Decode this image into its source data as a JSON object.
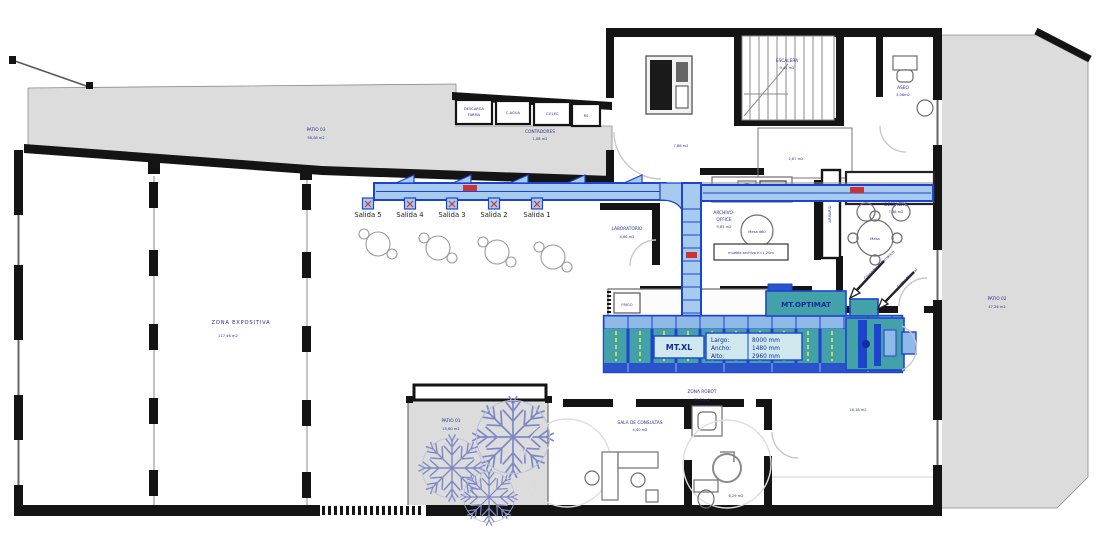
{
  "colors": {
    "patio_fill": "#dcdcdc",
    "wall": "#141414",
    "label_navy": "#2b2f94",
    "machine_blue": "#1d43cf",
    "machine_fill": "#a7cbee",
    "machine_teal": "#43a1a9",
    "accent_red": "#cc3333",
    "dash_yellow": "#e6f23a"
  },
  "exits": [
    "Salida 5",
    "Salida 4",
    "Salida 3",
    "Salida 2",
    "Salida 1"
  ],
  "machines": {
    "optimat_label": "MT.OPTIMAT",
    "xl_label": "MT.XL",
    "dims": [
      {
        "k": "Largo:",
        "v": "8000 mm"
      },
      {
        "k": "Ancho:",
        "v": "1480 mm"
      },
      {
        "k": "Alto:",
        "v": "2960 mm"
      }
    ],
    "arrow_auto": "Cargador Automático",
    "arrow_manual": "Carga Manual"
  },
  "rooms": {
    "patio03": {
      "name": "PATIO 03",
      "area": "98,08 m2"
    },
    "patio02": {
      "name": "PATIO 02",
      "area": "47,26 m2"
    },
    "patio01": {
      "name": "PATIO 01",
      "area": "15,60 m2"
    },
    "zona_expositiva": {
      "name": "ZONA EXPOSITIVA",
      "area": "117,46 m2"
    },
    "zona_robot": {
      "name": "ZONA ROBOT",
      "area": "35,81m2"
    },
    "sala_consultas": {
      "name": "SALA DE CONSULTAS",
      "area": "4,40 m2"
    },
    "laboratorio": {
      "name": "LABORATORIO",
      "area": "4,86 m2"
    },
    "archivo": {
      "line1": "ARCHIVO-",
      "line2": "OFFICE",
      "area": "9,85 m2"
    },
    "despacho": {
      "name": "DESPACHO",
      "area": "7,38 m2"
    },
    "escalera": {
      "name": "ESCALERA",
      "area": "9,41 m2"
    },
    "aseo": {
      "name": "ASEO",
      "area": "3,08m2"
    },
    "contadores": {
      "name": "CONTADORES",
      "area": "1,08 m2"
    },
    "descarga": {
      "line1": "DESCARGA",
      "line2": "FARMA"
    },
    "c_agua": "C.AGUA",
    "c_elec": "C.ELEC",
    "rs": "RS",
    "armario": "ARMARIO"
  },
  "annotations": {
    "mueble": "mueble archivo h=1,20m",
    "mesa_d80": "Mesa d80",
    "mesa": "Mesa",
    "frigo": "FRIGO",
    "area_788": "7,88 m2",
    "area_287": "2,87 m2",
    "area_1618": "16,18 m2",
    "area_629": "6,29 m2"
  }
}
